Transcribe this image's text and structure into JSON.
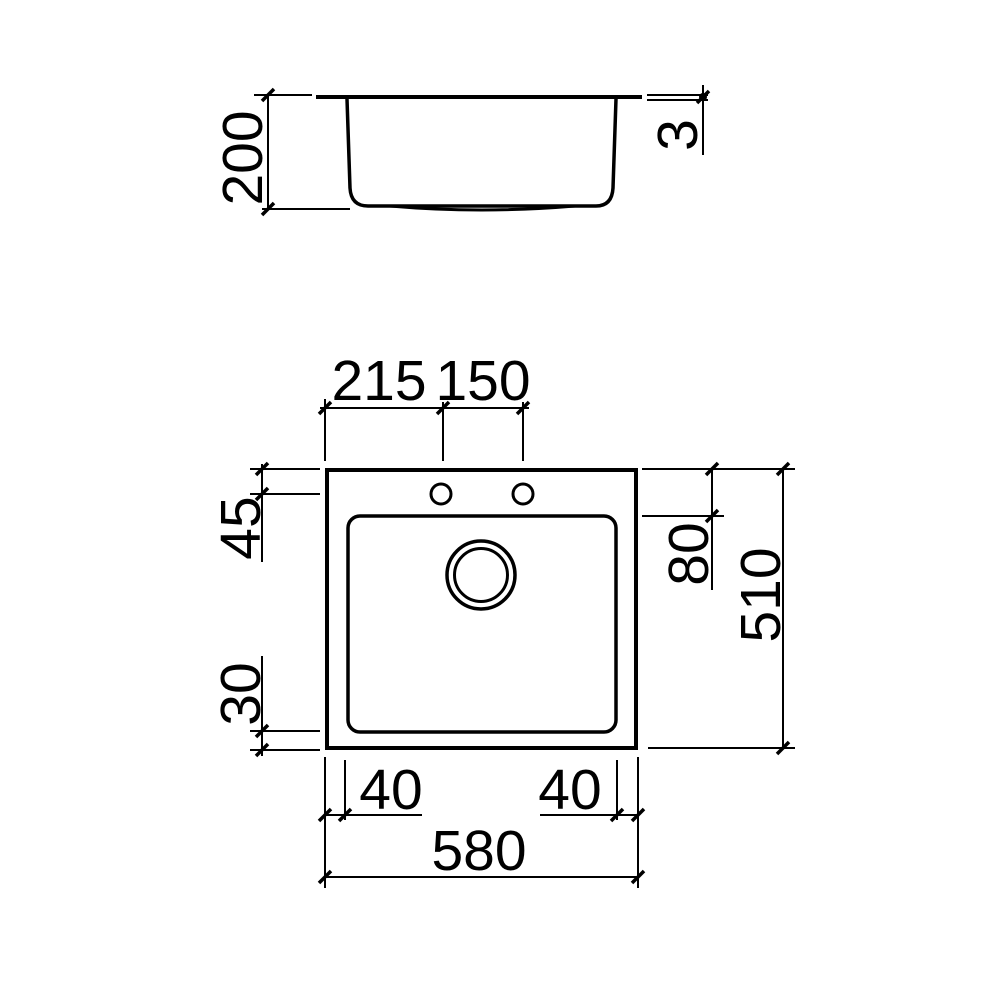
{
  "canvas": {
    "background": "#ffffff",
    "line_color": "#000000"
  },
  "side_view": {
    "labels": {
      "depth": "200",
      "rim_thickness": "3"
    }
  },
  "top_view": {
    "labels": {
      "holes_offset_left": "215",
      "holes_spacing": "150",
      "rim_to_holes": "45",
      "rim_to_bowl": "80",
      "overall_depth": "510",
      "bowl_to_front_edge": "30",
      "bowl_inset_left": "40",
      "bowl_inset_right": "40",
      "overall_width": "580"
    }
  }
}
